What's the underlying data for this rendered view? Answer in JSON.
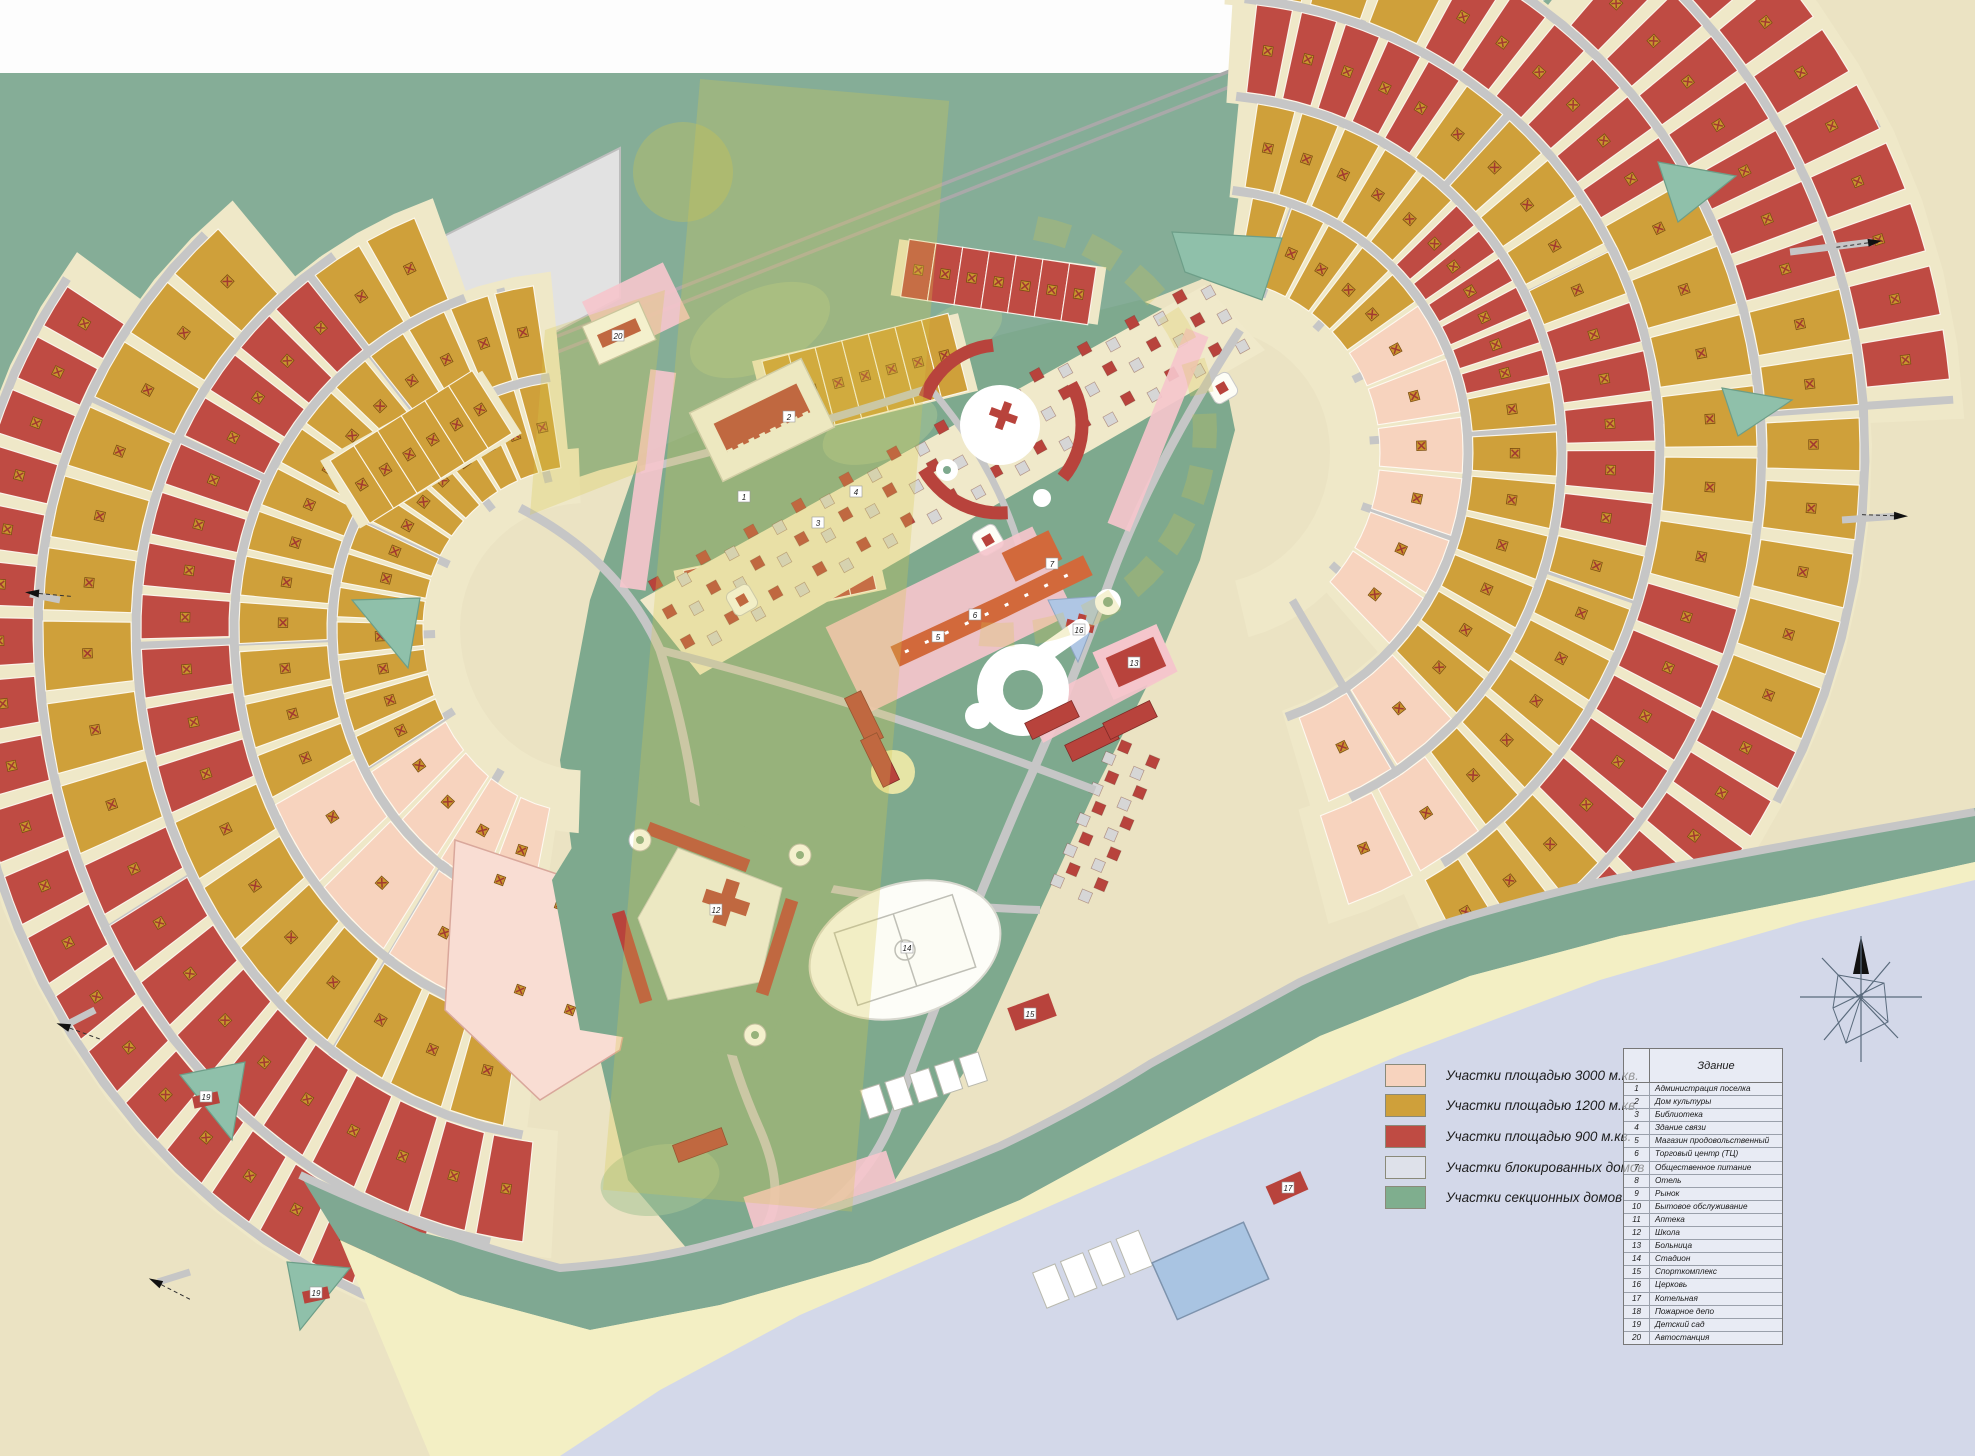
{
  "legend": {
    "items": [
      {
        "label": "Участки площадью 3000 м.кв.",
        "color": "#F7D3BE"
      },
      {
        "label": "Участки площадью 1200 м.кв.",
        "color": "#CFA03A"
      },
      {
        "label": "Участки площадью 900 м.кв.",
        "color": "#BF4B43"
      },
      {
        "label": "Участки блокированных домов",
        "color": "#DEE1EA"
      },
      {
        "label": "Участки секционных домов",
        "color": "#7FAE8E"
      }
    ]
  },
  "building_table": {
    "title": "Здание",
    "rows": [
      {
        "num": "1",
        "name": "Администрация поселка"
      },
      {
        "num": "2",
        "name": "Дом культуры"
      },
      {
        "num": "3",
        "name": "Библиотека"
      },
      {
        "num": "4",
        "name": "Здание связи"
      },
      {
        "num": "5",
        "name": "Магазин продовольственный"
      },
      {
        "num": "6",
        "name": "Торговый центр (ТЦ)"
      },
      {
        "num": "7",
        "name": "Общественное питание"
      },
      {
        "num": "8",
        "name": "Отель"
      },
      {
        "num": "9",
        "name": "Рынок"
      },
      {
        "num": "10",
        "name": "Бытовое обслуживание"
      },
      {
        "num": "11",
        "name": "Аптека"
      },
      {
        "num": "12",
        "name": "Школа"
      },
      {
        "num": "13",
        "name": "Больница"
      },
      {
        "num": "14",
        "name": "Стадион"
      },
      {
        "num": "15",
        "name": "Спорткомплекс"
      },
      {
        "num": "16",
        "name": "Церковь"
      },
      {
        "num": "17",
        "name": "Котельная"
      },
      {
        "num": "18",
        "name": "Пожарное депо"
      },
      {
        "num": "19",
        "name": "Детский сад"
      },
      {
        "num": "20",
        "name": "Автостанция"
      }
    ]
  },
  "map": {
    "colors": {
      "bg": "#EBE3C3",
      "white_zone": "#FDFDFD",
      "forest": "#85AD97",
      "shore": "#7FA892",
      "beach": "#F3EFC4",
      "water": "#D3D8E9",
      "industrial": "#E2E2E2",
      "road": "#C6C6C6",
      "road_edge": "#A9A9A9",
      "island": "#EFE8C8",
      "pink": "#F7D3BE",
      "ochre": "#CFA03A",
      "red": "#BF4B43",
      "pink_light": "#F9DDD3",
      "pond": "#8FC0AA",
      "park": "#7EA98E",
      "park_light": "#A6C495",
      "building_red": "#B8433C",
      "building_orange": "#D2693B",
      "church_pad": "#AFC6E4",
      "pink_strip": "#F5C6CC",
      "court_blue": "#A9C4E2",
      "block_gray": "#D6D6D6",
      "watermark": "#D6C94A",
      "icon_base": "#C9952E",
      "icon_x": "#A23A30",
      "compass": "#5A6B7D"
    },
    "building_labels": [
      {
        "num": "20",
        "x": 618,
        "y": 336
      },
      {
        "num": "2",
        "x": 789,
        "y": 417
      },
      {
        "num": "1",
        "x": 744,
        "y": 497
      },
      {
        "num": "4",
        "x": 856,
        "y": 492
      },
      {
        "num": "3",
        "x": 818,
        "y": 523
      },
      {
        "num": "5",
        "x": 938,
        "y": 637
      },
      {
        "num": "6",
        "x": 975,
        "y": 615
      },
      {
        "num": "7",
        "x": 1052,
        "y": 564
      },
      {
        "num": "16",
        "x": 1079,
        "y": 630
      },
      {
        "num": "13",
        "x": 1134,
        "y": 663
      },
      {
        "num": "12",
        "x": 716,
        "y": 910
      },
      {
        "num": "14",
        "x": 907,
        "y": 948
      },
      {
        "num": "15",
        "x": 1030,
        "y": 1014
      },
      {
        "num": "17",
        "x": 1288,
        "y": 1188
      },
      {
        "num": "19",
        "x": 206,
        "y": 1097
      },
      {
        "num": "19",
        "x": 316,
        "y": 1293
      }
    ]
  }
}
